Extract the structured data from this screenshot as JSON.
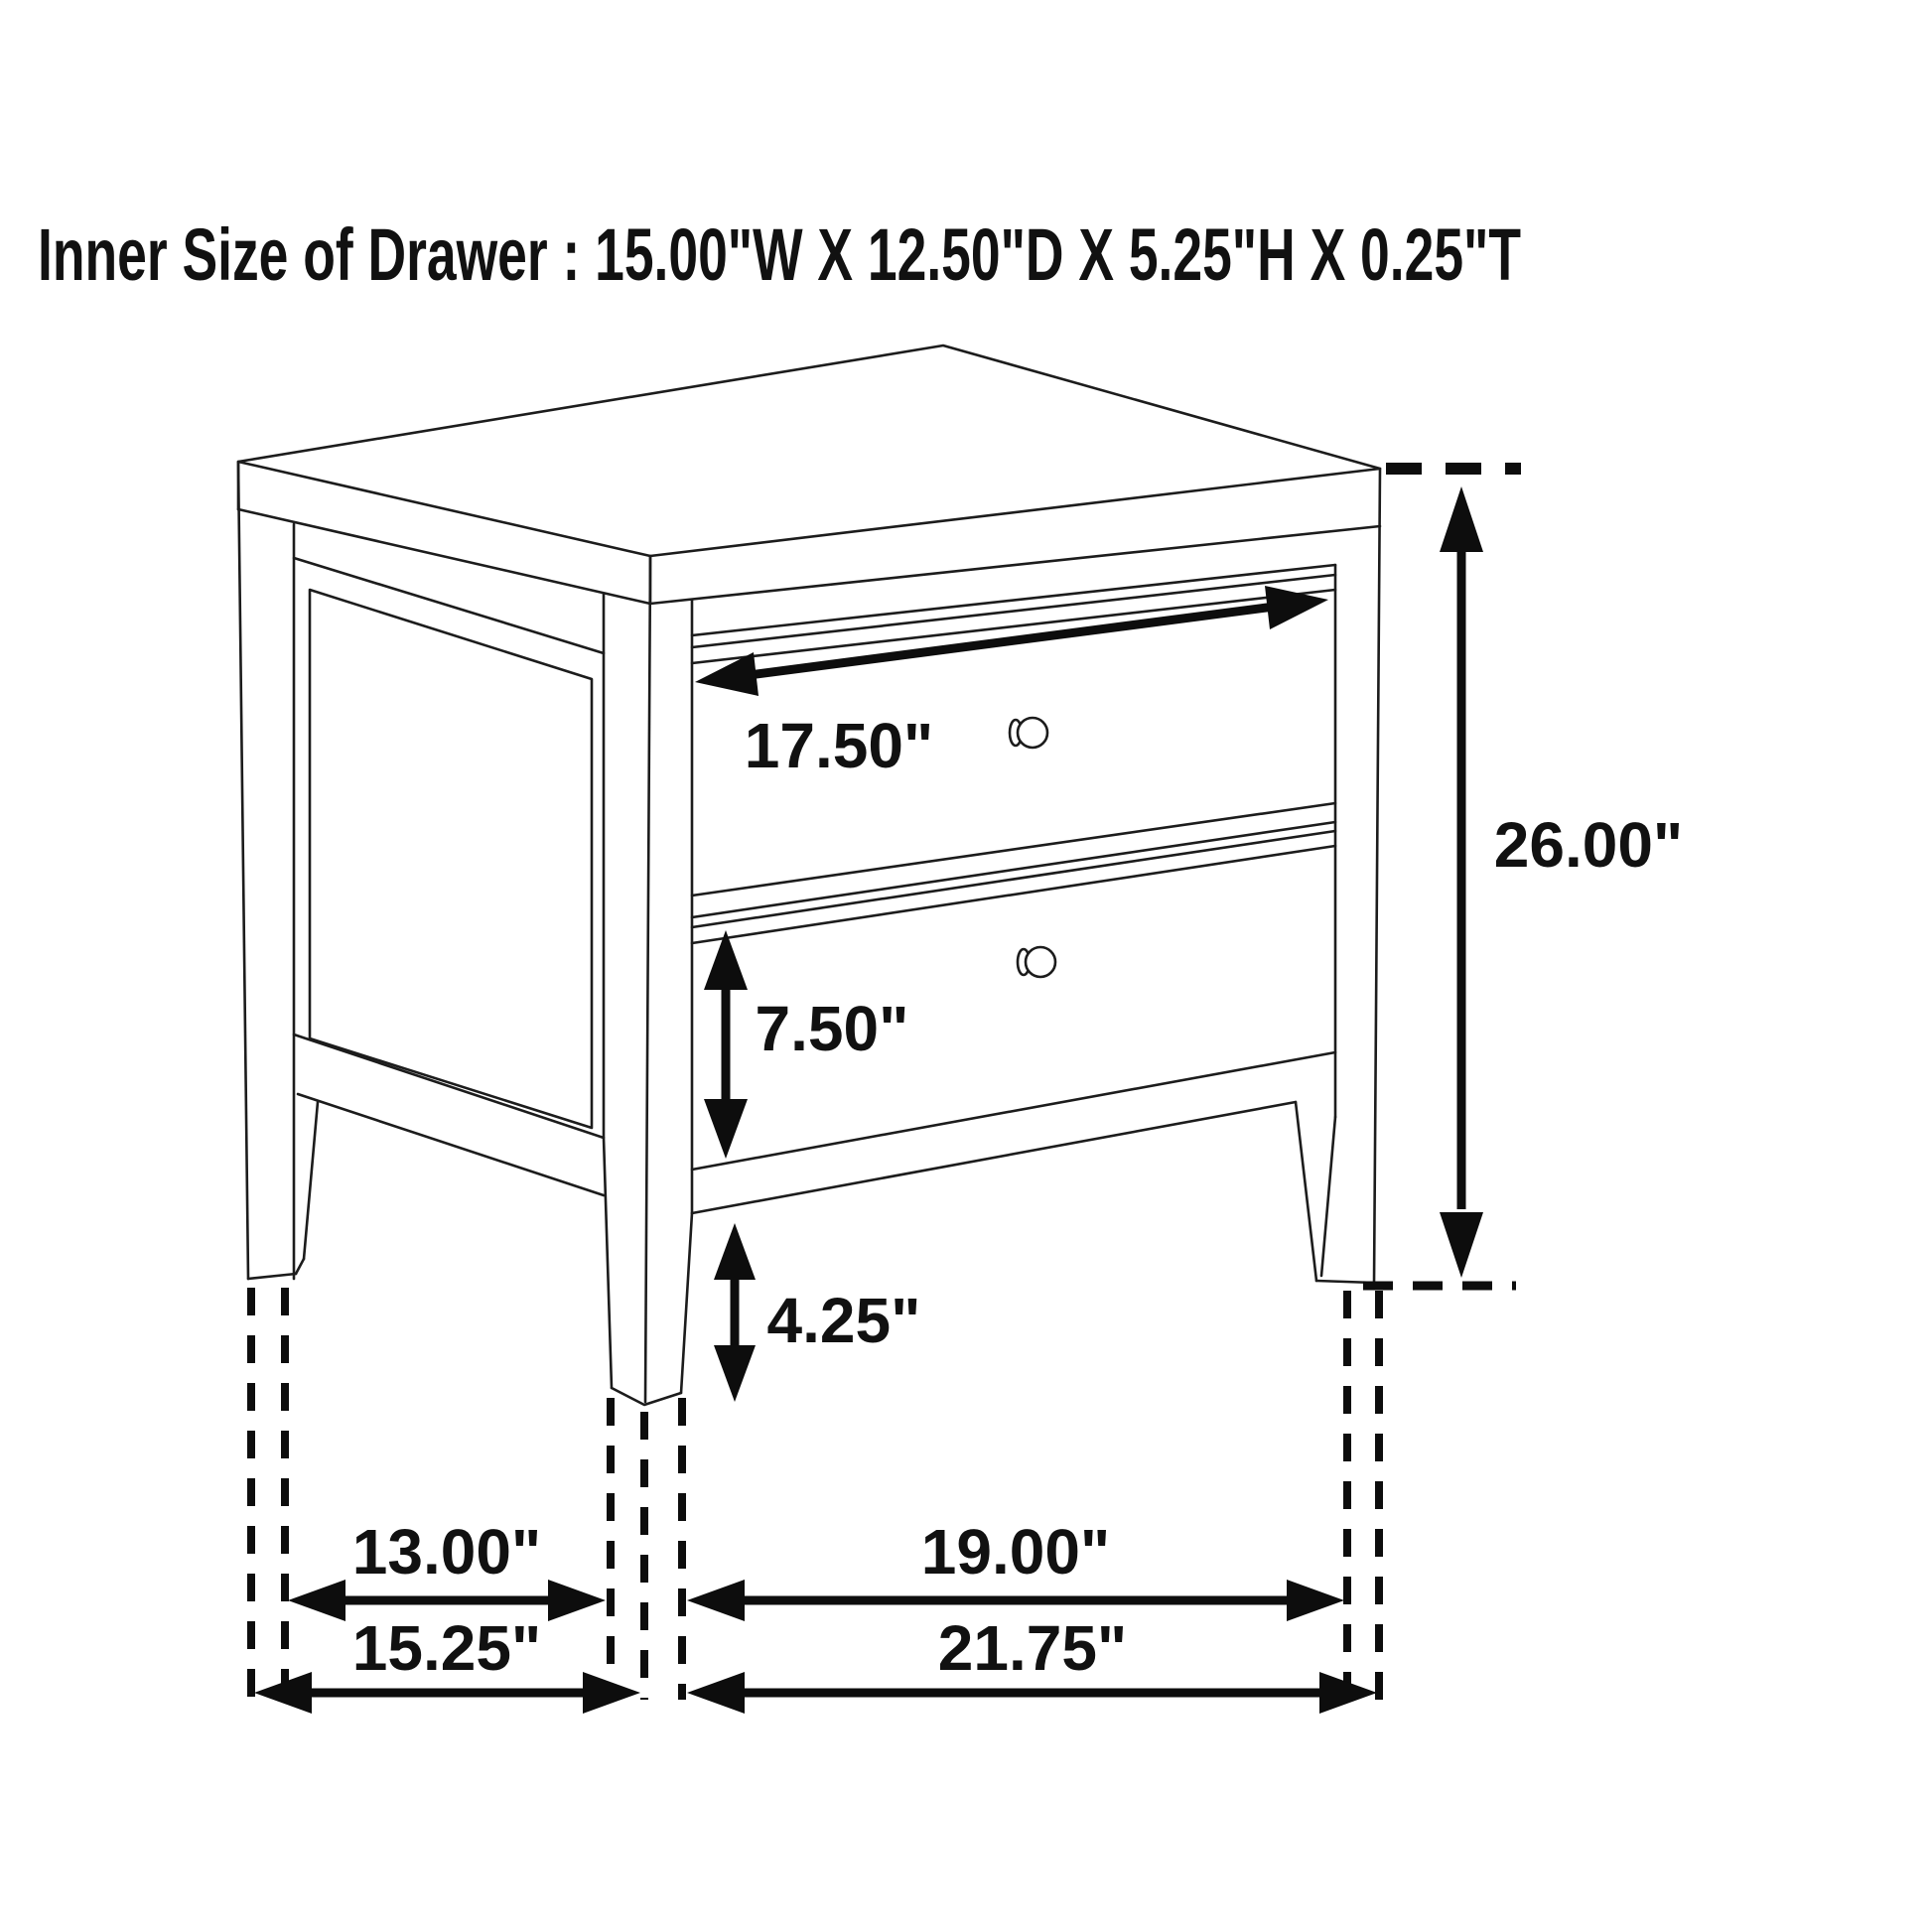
{
  "title": "Inner Size of Drawer : 15.00\"W X 12.50\"D X 5.25\"H X 0.25\"T",
  "labels": {
    "drawer_width": "17.50\"",
    "overall_height": "26.00\"",
    "bottom_drawer_height": "7.50\"",
    "leg_height": "4.25\"",
    "side_width_inner": "13.00\"",
    "side_width_overall": "15.25\"",
    "front_width_inner": "19.00\"",
    "front_width_overall": "21.75\""
  },
  "colors": {
    "line": "#1c1c1c",
    "dimension": "#0d0d0d",
    "background": "#ffffff",
    "text": "#111111"
  }
}
